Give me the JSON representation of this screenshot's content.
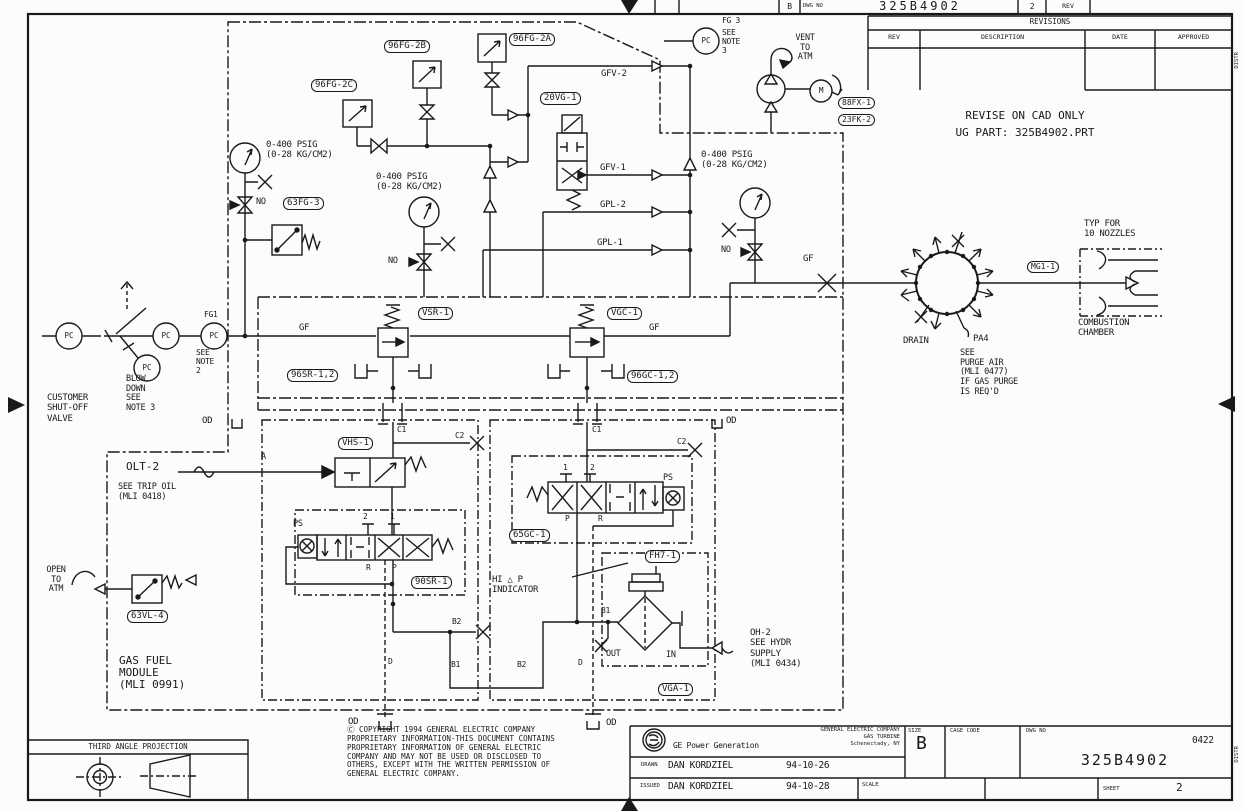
{
  "top_strip": {
    "size": "B",
    "dwg_no_label": "DWG NO",
    "dwg_no": "325B4902",
    "sheet": "2",
    "rev": "REV"
  },
  "revisions": {
    "title": "REVISIONS",
    "columns": [
      "REV",
      "DESCRIPTION",
      "DATE",
      "APPROVED"
    ]
  },
  "notes": {
    "cad": "REVISE ON CAD ONLY\nUG PART: 325B4902.PRT"
  },
  "tags": {
    "t96fg2c": "96FG-2C",
    "t96fg2b": "96FG-2B",
    "t96fg2a": "96FG-2A",
    "t20vg1": "20VG-1",
    "t63fg3": "63FG-3",
    "t88fx1": "88FX-1",
    "t23fk2": "23FK-2",
    "tvsr1": "VSR-1",
    "tvgc1": "VGC-1",
    "t96sr": "96SR-1,2",
    "t96gc": "96GC-1,2",
    "tvhs1": "VHS-1",
    "t90sr1": "90SR-1",
    "t65gc1": "65GC-1",
    "tfh71": "FH7-1",
    "tvga1": "VGA-1",
    "t63vl4": "63VL-4",
    "tmg11": "MG1-1"
  },
  "texts": {
    "gauge_range": "0-400 PSIG\n(0-28 KG/CM2)",
    "no": "NO",
    "gfv2": "GFV-2",
    "gfv1": "GFV-1",
    "gpl2": "GPL-2",
    "gpl1": "GPL-1",
    "gf": "GF",
    "pc": "PC",
    "fg1": "FG1",
    "fg3": "FG 3",
    "see_note_2": "SEE\nNOTE\n2",
    "see_note_3": "SEE\nNOTE\n3",
    "vent": "VENT\nTO\nATM",
    "motor": "M",
    "blowdown": "BLOW\nDOWN\nSEE\nNOTE 3",
    "customer": "CUSTOMER\nSHUT-OFF\nVALVE",
    "od": "OD",
    "c1": "C1",
    "c2": "C2",
    "a": "A",
    "olt2": "OLT-2",
    "trip": "SEE TRIP OIL\n(MLI 0418)",
    "ps": "PS",
    "n1": "1",
    "n2": "2",
    "r": "R",
    "p": "P",
    "b1": "B1",
    "b2": "B2",
    "d": "D",
    "out": "OUT",
    "in": "IN",
    "hidp": "HI △ P\nINDICATOR",
    "oh2": "OH-2\nSEE HYDR\nSUPPLY\n(MLI 0434)",
    "open_atm": "OPEN\nTO\nATM",
    "module": "GAS FUEL\nMODULE\n(MLI 0991)",
    "drain": "DRAIN",
    "pa4": "PA4",
    "purge": "SEE\nPURGE AIR\n(MLI 0477)\nIF GAS PURGE\nIS REQ'D",
    "typ": "TYP FOR\n10 NOZZLES",
    "comb": "COMBUSTION\nCHAMBER"
  },
  "title_block": {
    "third_angle": "THIRD ANGLE PROJECTION",
    "copyright": "Ⓒ  COPYRIGHT 1994 GENERAL ELECTRIC COMPANY\nPROPRIETARY INFORMATION-THIS DOCUMENT CONTAINS\nPROPRIETARY INFORMATION OF GENERAL ELECTRIC\nCOMPANY AND MAY NOT BE USED OR DISCLOSED TO\nOTHERS, EXCEPT WITH THE WRITTEN PERMISSION OF\nGENERAL ELECTRIC COMPANY.",
    "company": "GENERAL ELECTRIC COMPANY\nGAS TURBINE\nSchenectady, NY",
    "ge_power": "GE Power Generation",
    "drawn_label": "DRAWN",
    "drawn_name": "DAN KORDZIEL",
    "drawn_date": "94-10-26",
    "issued_label": "ISSUED",
    "issued_name": "DAN KORDZIEL",
    "issued_date": "94-10-28",
    "size_label": "SIZE",
    "size": "B",
    "cage_label": "CAGE CODE",
    "dwg_label": "DWG NO",
    "dwg_code": "0422",
    "dwg_no": "325B4902",
    "scale_label": "SCALE",
    "sheet_label": "SHEET",
    "sheet": "2",
    "distr": "DISTR"
  }
}
